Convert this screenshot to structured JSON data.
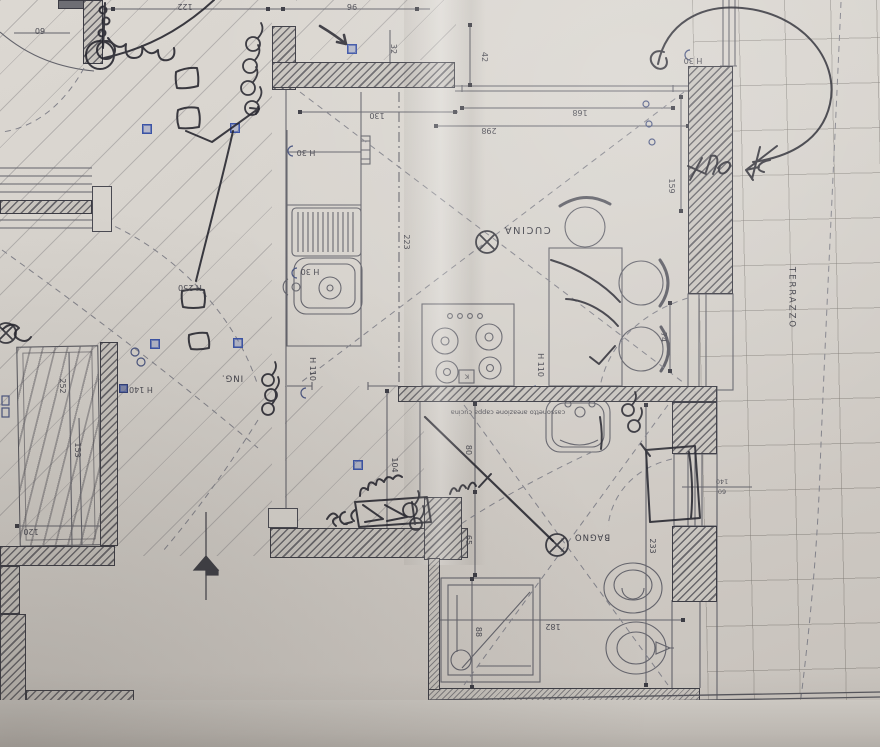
{
  "document": {
    "kind": "floor plan photo",
    "orientation": "plan photographed upside down; printed labels appear rotated 180°"
  },
  "rooms": {
    "kitchen": "CUCINA",
    "bathroom": "BAGNO",
    "entry": "ING.",
    "terrace": "TERRAZZO"
  },
  "notes": {
    "vent_duct": "cassonetto areazione cappa cucina"
  },
  "dimensions": {
    "d122": "122",
    "d96": "96",
    "d60": "60",
    "d32": "32",
    "d130": "130",
    "d42": "42",
    "d168": "168",
    "d298": "298",
    "d159": "159",
    "d223": "223",
    "d74": "74",
    "d104": "104",
    "d80": "80",
    "d65": "65",
    "d233": "233",
    "d182": "182",
    "d88": "88",
    "d120": "120",
    "d252": "252",
    "d153": "153",
    "window_w": "140",
    "window_h": "60"
  },
  "height_labels": {
    "h30": "H 30",
    "h110": "H 110",
    "h140": "H 140",
    "h250": "H 250"
  },
  "marks": {
    "hob_k": "K"
  },
  "colors": {
    "paper": "#d6d2cc",
    "print_line": "#63636b",
    "wall_dark": "#3c3c44",
    "pen_ink": "#23232c",
    "socket_blue": "#3b53a6"
  }
}
